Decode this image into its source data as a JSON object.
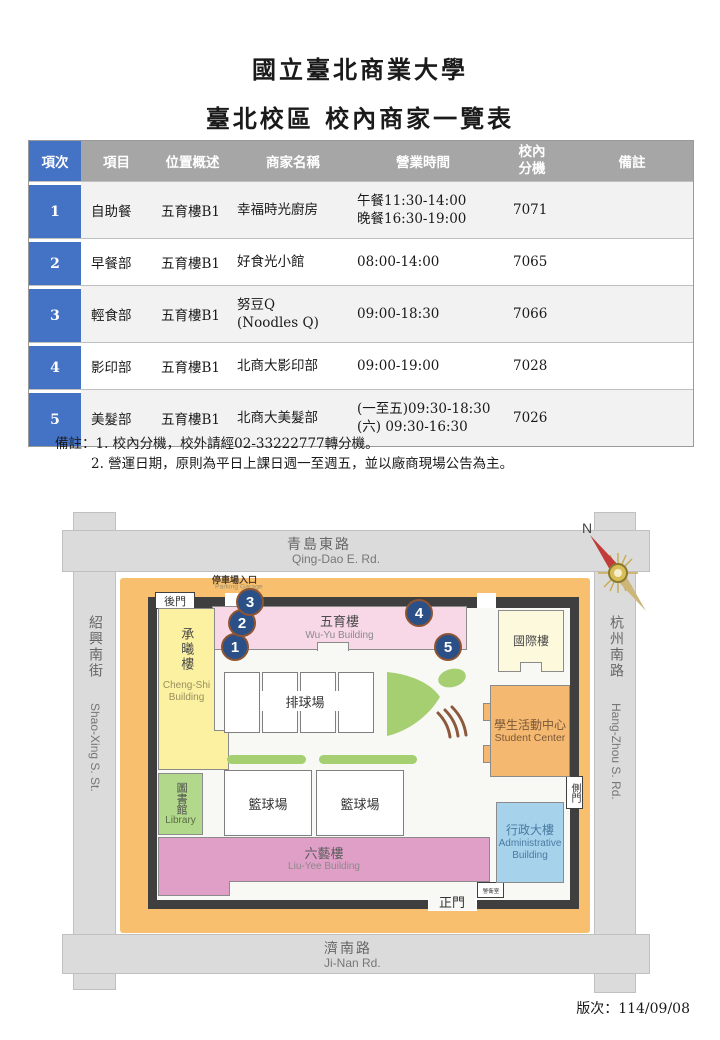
{
  "page": {
    "title": "國立臺北商業大學",
    "subtitle": "臺北校區 校內商家一覽表",
    "version_label": "版次：114/09/08"
  },
  "table": {
    "headers": [
      "項次",
      "項目",
      "位置概述",
      "商家名稱",
      "營業時間",
      "校內\n分機",
      "備註"
    ],
    "rows": [
      {
        "no": "1",
        "category": "自助餐",
        "location": "五育樓B1",
        "name": "幸福時光廚房",
        "hours": "午餐11:30-14:00\n晚餐16:30-19:00",
        "ext": "7071",
        "note": ""
      },
      {
        "no": "2",
        "category": "早餐部",
        "location": "五育樓B1",
        "name": "好食光小館",
        "hours": "08:00-14:00",
        "ext": "7065",
        "note": ""
      },
      {
        "no": "3",
        "category": "輕食部",
        "location": "五育樓B1",
        "name": "努豆Q\n(Noodles Q)",
        "hours": "09:00-18:30",
        "ext": "7066",
        "note": ""
      },
      {
        "no": "4",
        "category": "影印部",
        "location": "五育樓B1",
        "name": "北商大影印部",
        "hours": "09:00-19:00",
        "ext": "7028",
        "note": ""
      },
      {
        "no": "5",
        "category": "美髮部",
        "location": "五育樓B1",
        "name": "北商大美髮部",
        "hours": "(一至五)09:30-18:30\n(六) 09:30-16:30",
        "ext": "7026",
        "note": ""
      }
    ]
  },
  "notes": {
    "line1": "備註：1. 校內分機，校外請經02-33222777轉分機。",
    "line2": "2. 營運日期，原則為平日上課日週一至週五，並以廠商現場公告為主。"
  },
  "map": {
    "compass_label": "N",
    "roads": {
      "top_zh": "青島東路",
      "top_en": "Qing-Dao E. Rd.",
      "bottom_zh": "濟南路",
      "bottom_en": "Ji-Nan Rd.",
      "left_zh": "紹興南街",
      "left_en": "Shao-Xing S. St.",
      "right_zh": "杭州南路",
      "right_en": "Hang-Zhou S. Rd."
    },
    "gates": {
      "back": "後門",
      "side": "側門",
      "main": "正門",
      "parking_zh": "停車場入口",
      "parking_en": "Parking Garage",
      "guard": "警衛室"
    },
    "buildings": {
      "wuyu_zh": "五育樓",
      "wuyu_en": "Wu-Yu Building",
      "intl_zh": "國際樓",
      "chengshi_zh": "承曦樓",
      "chengshi_en": "Cheng-Shi\nBuilding",
      "library_zh": "圖書館",
      "library_en": "Library",
      "student_zh": "學生活動中心",
      "student_en": "Student Center",
      "admin_zh": "行政大樓",
      "admin_en": "Administrative\nBuilding",
      "liuyee_zh": "六藝樓",
      "liuyee_en": "Liu-Yee Building",
      "volleyball": "排球場",
      "basketball1": "籃球場",
      "basketball2": "籃球場"
    },
    "markers": [
      "1",
      "2",
      "3",
      "4",
      "5"
    ],
    "colors": {
      "header_gray": "#a6a6a6",
      "index_blue": "#4472c4",
      "row_shade": "#f2f2f2",
      "road_gray": "#dbdbdb",
      "campus_orange": "#f8c06e",
      "wall_dark": "#3f3f3f",
      "wuyu_pink": "#f8d7e6",
      "liuyee_pink": "#df9fc6",
      "chengshi_yellow": "#fbf1a0",
      "intl_cream": "#fcf9dd",
      "library_green": "#b2d98b",
      "student_orange": "#f4b870",
      "admin_blue": "#a6d2ec",
      "land_green": "#a5cf70",
      "marker_navy": "#2b5087"
    }
  }
}
